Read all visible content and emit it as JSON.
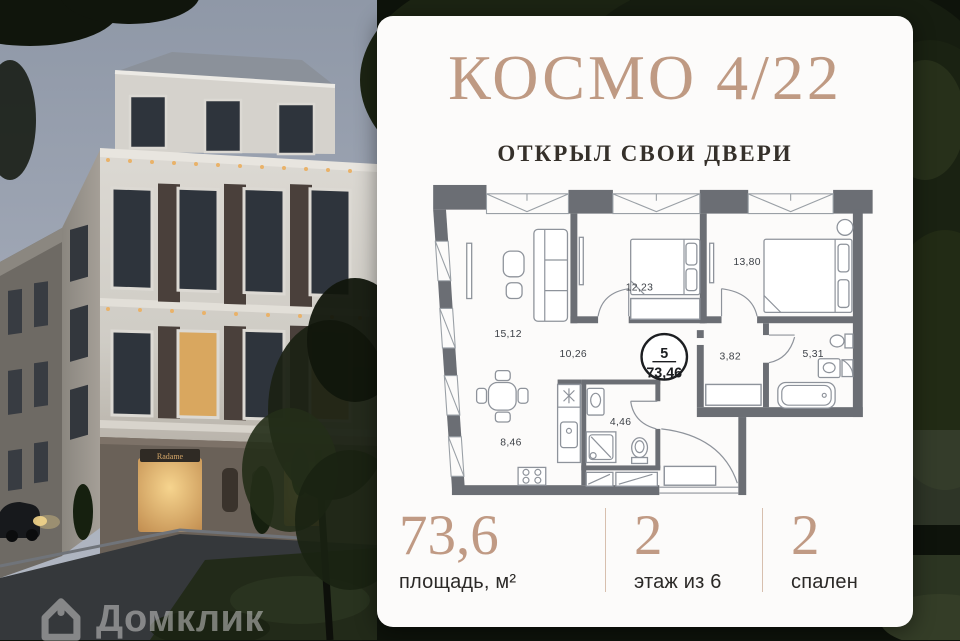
{
  "photo": {
    "storefront_sign": "Radame"
  },
  "watermark": {
    "brand": "Домклик"
  },
  "card": {
    "title": "КОСМО 4/22",
    "subtitle": "ОТКРЫЛ СВОИ ДВЕРИ",
    "stats": [
      {
        "value": "73,6",
        "label": "площадь, м²"
      },
      {
        "value": "2",
        "label": "этаж из 6"
      },
      {
        "value": "2",
        "label": "спален"
      }
    ]
  },
  "floor_plan": {
    "badge": {
      "flat_number": "5",
      "total_area": "73,46"
    },
    "rooms": [
      {
        "name": "living-room",
        "area": "15,12"
      },
      {
        "name": "bedroom-1",
        "area": "12,23"
      },
      {
        "name": "bedroom-2",
        "area": "13,80"
      },
      {
        "name": "corridor",
        "area": "10,26"
      },
      {
        "name": "hallway",
        "area": "3,82"
      },
      {
        "name": "bathroom-1",
        "area": "5,31"
      },
      {
        "name": "kitchen",
        "area": "8,46"
      },
      {
        "name": "bathroom-2",
        "area": "4,46"
      }
    ]
  },
  "colors": {
    "accent_tan": "#bf9a83",
    "text_dark": "#2b2927",
    "plan_wall": "#6b6e74",
    "card_bg": "#fcfbfa"
  }
}
